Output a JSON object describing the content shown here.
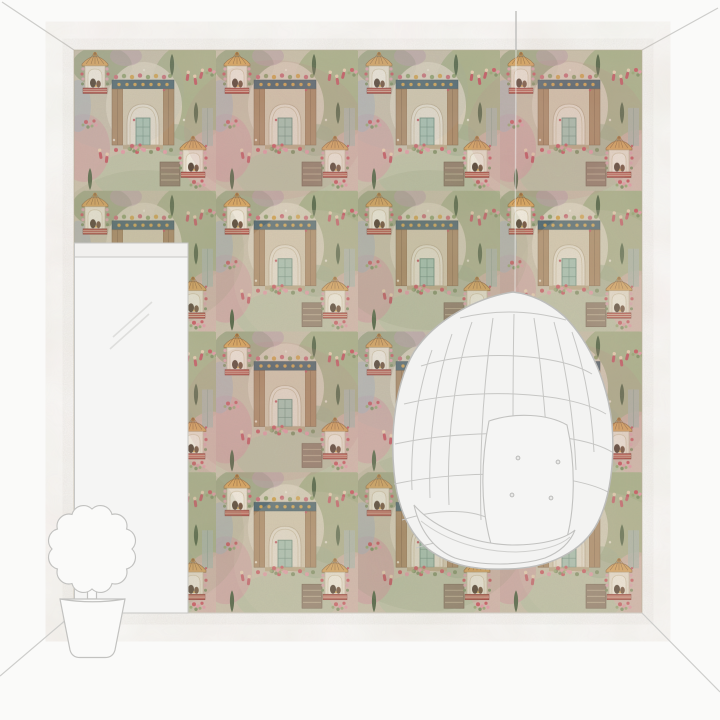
{
  "scene": {
    "type": "product-room-visualization",
    "subject": "collage-style oriental garden wallpaper shown on a feature wall in a sketched room",
    "objects": [
      {
        "name": "wallpaper-wall",
        "label": "patterned feature wall"
      },
      {
        "name": "ceiling-line-left",
        "label": "perspective ceiling line, top left"
      },
      {
        "name": "ceiling-line-right",
        "label": "perspective ceiling line, top right"
      },
      {
        "name": "door-panel",
        "label": "white door with transom bar"
      },
      {
        "name": "glass-reflection",
        "label": "diagonal reflection marks on door"
      },
      {
        "name": "hanging-cord",
        "label": "suspension cord of egg chair"
      },
      {
        "name": "hanging-egg-chair",
        "label": "white hanging egg chair line art with lattice, back cushion and seat roll"
      },
      {
        "name": "topiary-plant",
        "label": "potted topiary plant line art"
      },
      {
        "name": "floor-line",
        "label": "wall-floor junction line"
      },
      {
        "name": "floor-corner-left",
        "label": "perspective floor line, bottom left"
      },
      {
        "name": "floor-corner-right",
        "label": "perspective floor line, bottom right"
      }
    ],
    "wallpaper_motifs": [
      "stone archway with teal tiled door",
      "gold canopied niche with seated figures on red striped dais",
      "pink and red dancing figures",
      "cypress trees",
      "floral clusters",
      "tapestry panels"
    ]
  },
  "palette": {
    "bg": "#fafaf9",
    "outline": "#cdcdcb",
    "panel_fill": "#f5f5f4",
    "panel_bar_fill": "#f1f0ee",
    "chair_fill": "#f3f3f2",
    "chair_line": "#c6c6c4",
    "wallpaper_base": "#c9c0aa",
    "wallpaper_green": "#a3ad85",
    "wallpaper_green_dark": "#4e6242",
    "wallpaper_pink": "#cfa3a1",
    "wallpaper_rose": "#dca4ae",
    "wallpaper_red": "#b0493f",
    "wallpaper_cream": "#ded5c2",
    "wallpaper_teal": "#a3c2b2",
    "wallpaper_tan": "#a8855f",
    "wallpaper_navy": "#45606b",
    "wallpaper_gold": "#d9a257",
    "wallpaper_grey_blue": "#a9b0ba"
  }
}
